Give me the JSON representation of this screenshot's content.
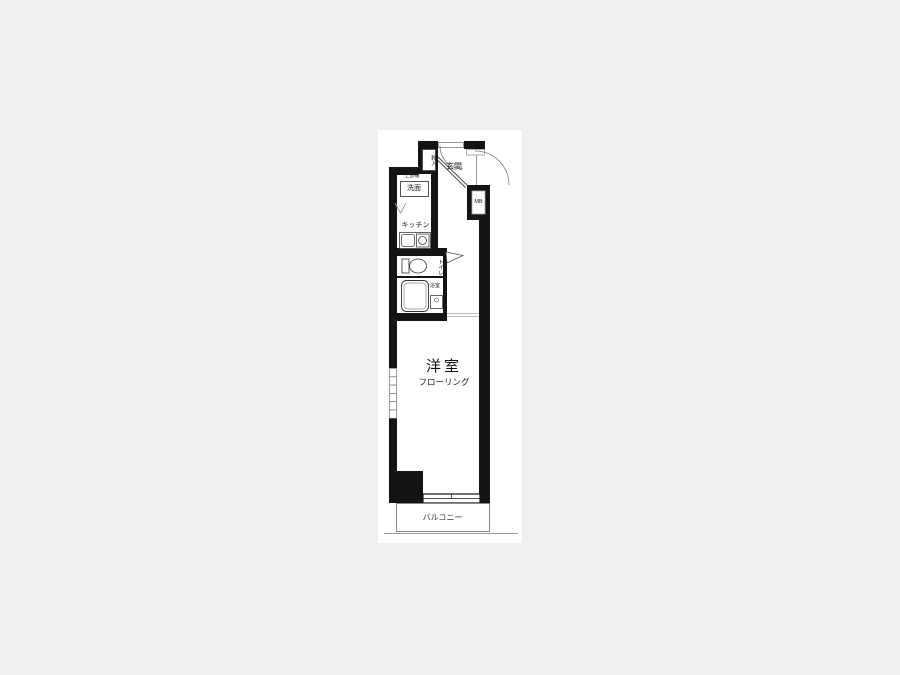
{
  "canvas": {
    "background": "#f0f0f0",
    "page_background": "#ffffff",
    "wall_color": "#141414",
    "line_color": "#555555"
  },
  "floor_plan": {
    "entrance": {
      "label": "玄関",
      "shoe_cabinet_label": "靴入",
      "meter_box_label": "MB"
    },
    "washroom": {
      "upper_shelf_label": "上部棚",
      "washbasin_label": "洗面"
    },
    "kitchen": {
      "label": "キッチン"
    },
    "toilet": {
      "label": "トイレ"
    },
    "bathroom": {
      "label": "浴室"
    },
    "main_room": {
      "label": "洋室",
      "sublabel": "フローリング"
    },
    "balcony": {
      "label": "バルコニー"
    }
  }
}
